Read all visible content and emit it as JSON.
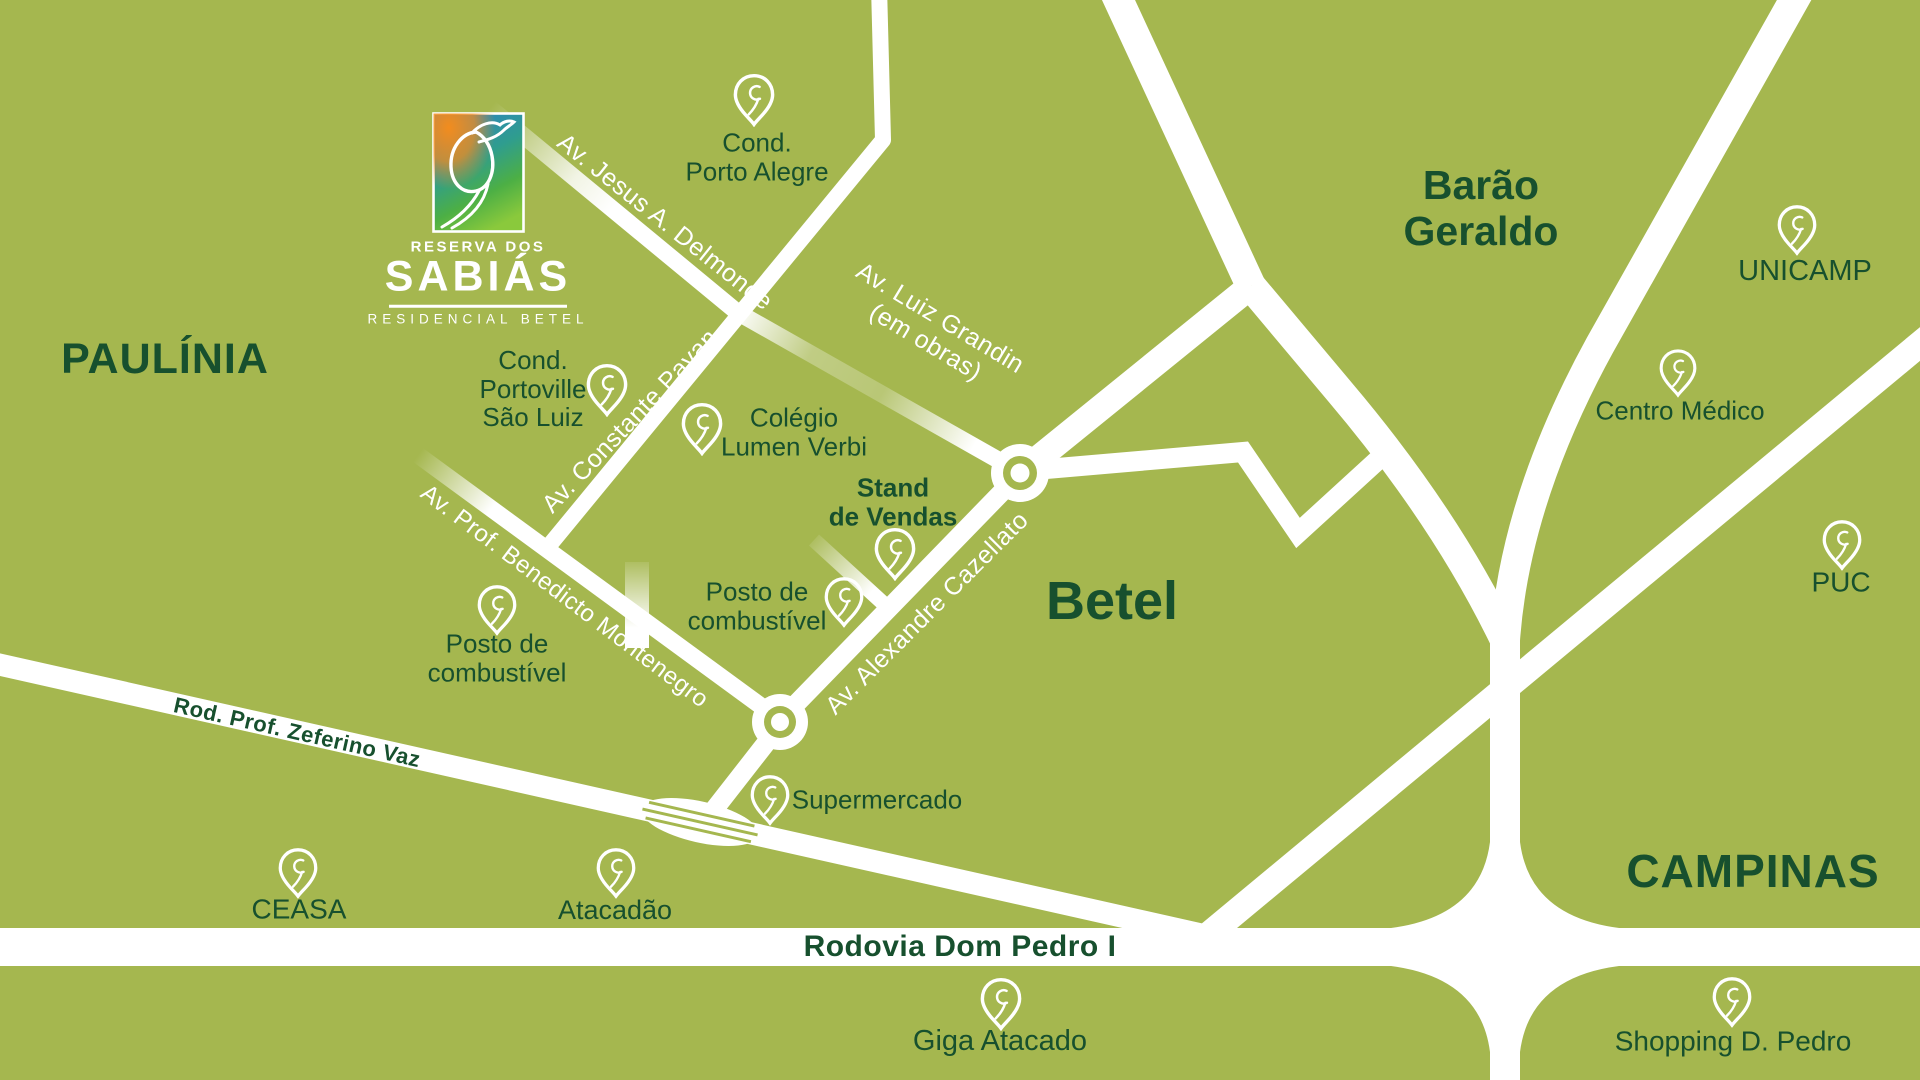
{
  "colors": {
    "map_green": "#a5b74f",
    "text_dark_green": "#17502e",
    "road_white": "#ffffff",
    "logo_orange": "#f28c1e",
    "logo_blue": "#2e81c4",
    "logo_green": "#7cc63d"
  },
  "logo": {
    "brand_top": "RESERVA DOS",
    "brand_name": "SABIÁS",
    "brand_sub": "RESIDENCIAL BETEL"
  },
  "regions": {
    "paulinia": "PAULÍNIA",
    "barao_line1": "Barão",
    "barao_line2": "Geraldo",
    "betel": "Betel",
    "campinas": "CAMPINAS"
  },
  "roads": {
    "jesus_delmonde": "Av. Jesus A. Delmonde",
    "luiz_grandin": "Av. Luiz Grandin",
    "luiz_grandin_note": "(em obras)",
    "constante_pavan": "Av. Constante Pavan",
    "benedicto_montenegro": "Av. Prof. Benedicto Montenegro",
    "alexandre_cazellato": "Av. Alexandre Cazellato",
    "zeferino_vaz": "Rod. Prof. Zeferino Vaz",
    "dom_pedro": "Rodovia Dom Pedro I"
  },
  "pois": {
    "porto_alegre": {
      "lines": [
        "Cond.",
        "Porto Alegre"
      ]
    },
    "portoville": {
      "lines": [
        "Cond.",
        "Portoville",
        "São Luiz"
      ]
    },
    "colegio": {
      "lines": [
        "Colégio",
        "Lumen Verbi"
      ]
    },
    "stand": {
      "lines": [
        "Stand",
        "de Vendas"
      ]
    },
    "posto_central": {
      "lines": [
        "Posto de",
        "combustível"
      ]
    },
    "posto_oeste": {
      "lines": [
        "Posto de",
        "combustível"
      ]
    },
    "supermercado": {
      "lines": [
        "Supermercado"
      ]
    },
    "ceasa": {
      "lines": [
        "CEASA"
      ]
    },
    "atacadao": {
      "lines": [
        "Atacadão"
      ]
    },
    "giga_atacado": {
      "lines": [
        "Giga Atacado"
      ]
    },
    "unicamp": {
      "lines": [
        "UNICAMP"
      ]
    },
    "centro_medico": {
      "lines": [
        "Centro Médico"
      ]
    },
    "puc": {
      "lines": [
        "PUC"
      ]
    },
    "shopping": {
      "lines": [
        "Shopping D. Pedro"
      ]
    }
  }
}
